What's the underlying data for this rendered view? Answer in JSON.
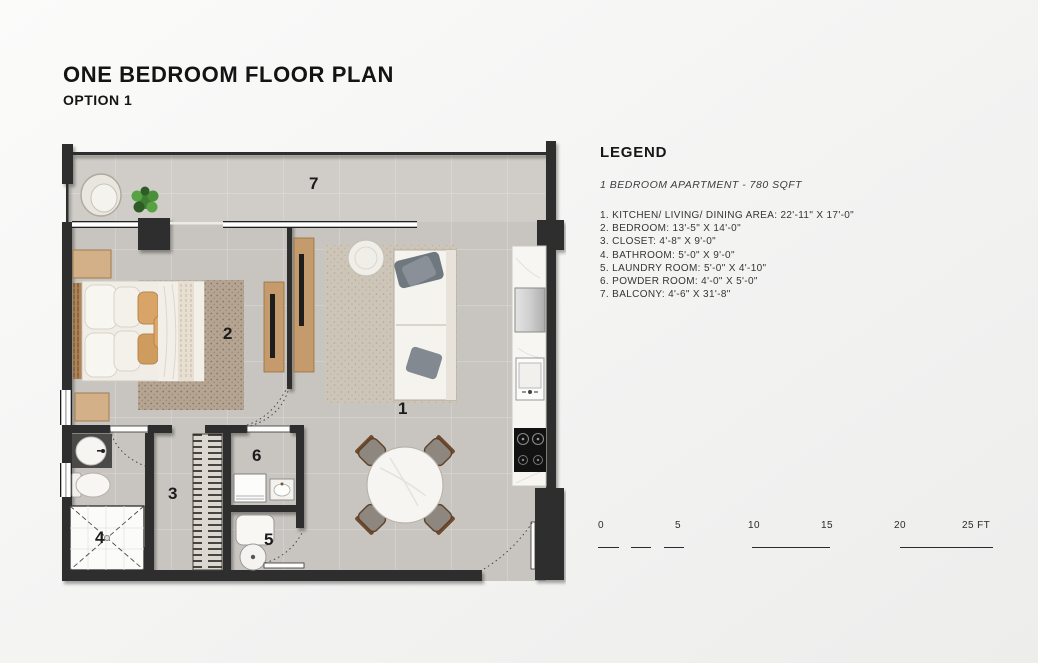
{
  "header": {
    "title": "ONE BEDROOM FLOOR PLAN",
    "subtitle": "OPTION 1"
  },
  "legend": {
    "heading": "LEGEND",
    "unit_summary": "1 BEDROOM APARTMENT - 780 SQFT",
    "items": [
      "1. KITCHEN/ LIVING/ DINING AREA: 22'-11\" X 17'-0\"",
      "2. BEDROOM: 13'-5\" X 14'-0\"",
      "3. CLOSET: 4'-8\" X 9'-0\"",
      "4. BATHROOM: 5'-0\" X 9'-0\"",
      "5. LAUNDRY ROOM: 5'-0\" X 4'-10\"",
      "6. POWDER ROOM: 4'-0\" X 5'-0\"",
      "7. BALCONY: 4'-6\" X 31'-8\""
    ]
  },
  "floor_plan": {
    "labels": {
      "living_dining_kitchen": "1",
      "bedroom": "2",
      "closet": "3",
      "bathroom": "4",
      "laundry": "5",
      "powder": "6",
      "balcony": "7"
    }
  },
  "scale_bar": {
    "unit": "FT",
    "labels": [
      "0",
      "5",
      "10",
      "15",
      "20",
      "25 FT"
    ]
  },
  "colors": {
    "wall": "#2d2d2d",
    "floor": "#c8c5c0",
    "balcony_floor": "#d0cdc8",
    "plant": "#4a8f3a",
    "background": "#f3f3f2"
  }
}
